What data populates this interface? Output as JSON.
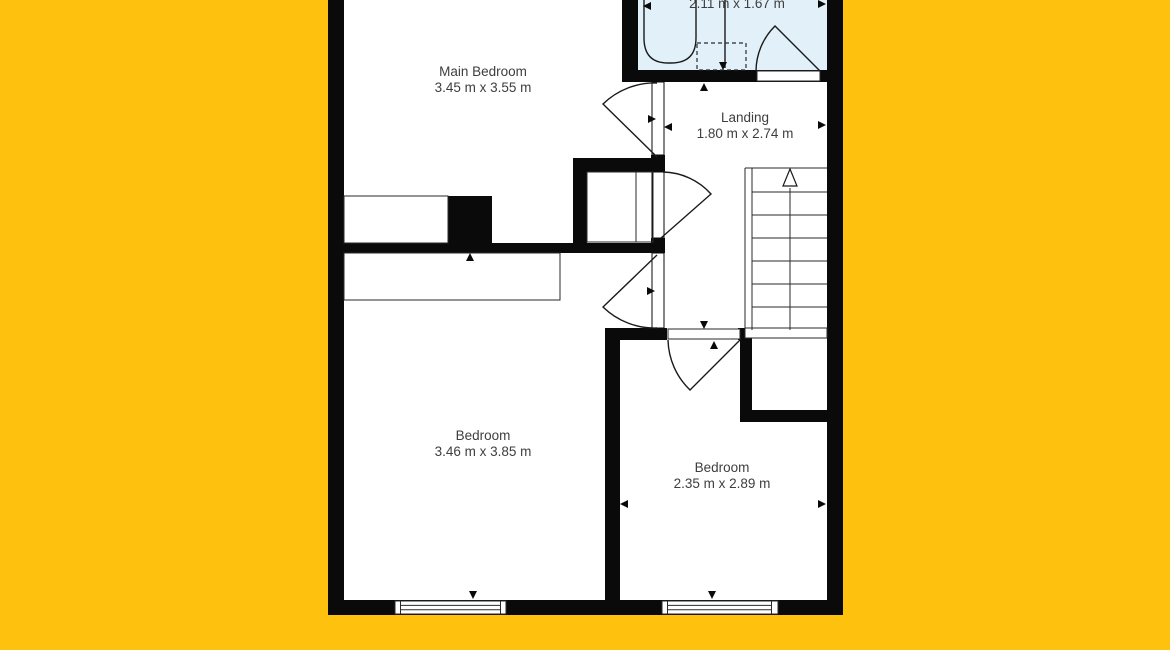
{
  "page": {
    "background_color": "#FEC20E",
    "wall_color": "#0a0a0a",
    "floor_color": "#ffffff",
    "bathroom_fill_color": "#E2F0F9",
    "label_text_color": "#3e3e3e"
  },
  "floorplan": {
    "rooms": {
      "main_bedroom": {
        "name": "Main Bedroom",
        "dimensions": "3.45 m x 3.55 m"
      },
      "bathroom": {
        "dimensions": "2.11 m x 1.67 m"
      },
      "landing": {
        "name": "Landing",
        "dimensions": "1.80 m x 2.74 m"
      },
      "bedroom_left": {
        "name": "Bedroom",
        "dimensions": "3.46 m x 3.85 m"
      },
      "bedroom_right": {
        "name": "Bedroom",
        "dimensions": "2.35 m x 2.89 m"
      }
    }
  }
}
